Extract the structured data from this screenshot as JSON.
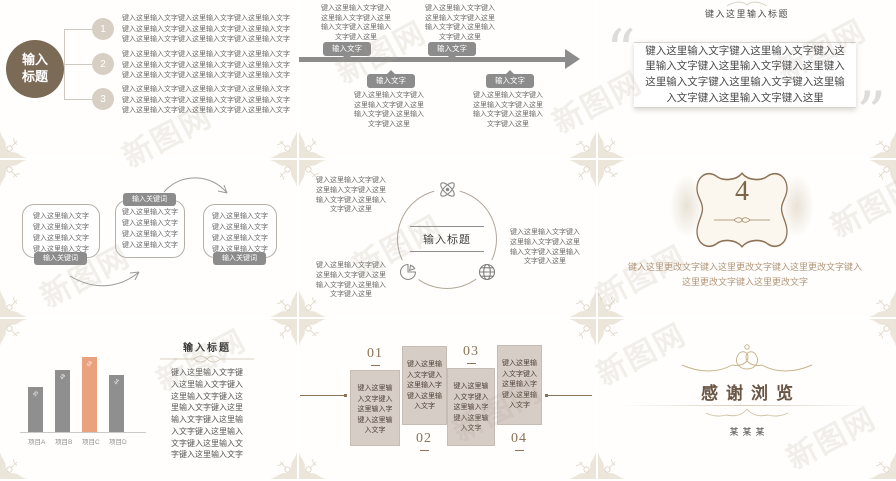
{
  "watermark": {
    "text": "新图网"
  },
  "s1": {
    "title": "输入\n标题",
    "items": [
      {
        "num": "1",
        "text": "键入这里输入文字键入这里输入文字键入这里输入文字键入这里输入文字键入这里输入文字键入这里输入文字键入这里输入文字键入这里输入文字键入这里输入文字"
      },
      {
        "num": "2",
        "text": "键入这里输入文字键入这里输入文字键入这里输入文字键入这里输入文字键入这里输入文字键入这里输入文字键入这里输入文字键入这里输入文字键入这里输入文字"
      },
      {
        "num": "3",
        "text": "键入这里输入文字键入这里输入文字键入这里输入文字键入这里输入文字键入这里输入文字键入这里输入文字键入这里输入文字键入这里输入文字键入这里输入文字"
      }
    ]
  },
  "s2": {
    "label": "输入文字",
    "block": "键入这里输入文字键入这里输入文字键入这里输入文字键入这里输入文字键入这里"
  },
  "s3": {
    "title": "键入这里输入标题",
    "body": "键入这里输入文字键入这里输入文字键入这里输入文字键入这里输入文字键入这里键入这里输入文字键入这里输入文字键入这里输入文字键入这里输入文字键入这里"
  },
  "s4": {
    "label": "输入关键词",
    "box": "键入这里输入文字\n键入这里输入文字\n键入这里输入文字\n键入这里输入文字"
  },
  "s5": {
    "title": "输入标题",
    "block": "键入这里输入文字键入这里输入文字键入这里输入文字键入这里输入文字键入这里",
    "icons": [
      "atom-icon",
      "pie-chart-icon",
      "globe-icon"
    ]
  },
  "s6": {
    "number": "4",
    "body": "键入这里更改文字键入这里更改文字键入这里更改文字键入这里更改文字键入这里更改文字"
  },
  "s7": {
    "title": "输入标题",
    "body": "键入这里输入文字键入这里输入文字键入这里输入文字键入这里输入文字键入这里输入文字键入这里输入文字键入这里输入文字键入这里输入文字键入这里输入文字",
    "chart": {
      "type": "bar",
      "categories": [
        "项目A",
        "项目B",
        "项目C",
        "项目D"
      ],
      "values": [
        35,
        48,
        58,
        44
      ],
      "highlight_index": 2,
      "bar_color": "#8f8f8f",
      "highlight_color": "#e9a17e",
      "ylim": [
        0,
        65
      ]
    }
  },
  "s8": {
    "steps": [
      {
        "num": "01",
        "text": "键入这里输入文字键入这里输入字键入这里输入文字"
      },
      {
        "num": "02",
        "text": "键入这里输入文字键入这里输入字键入这里输入文字"
      },
      {
        "num": "03",
        "text": "键入这里输入文字键入这里输入字键入这里输入文字"
      },
      {
        "num": "04",
        "text": "键入这里输入文字键入这里输入字键入这里输入文字"
      }
    ]
  },
  "s9": {
    "title": "感谢浏览",
    "name": "某某某"
  }
}
